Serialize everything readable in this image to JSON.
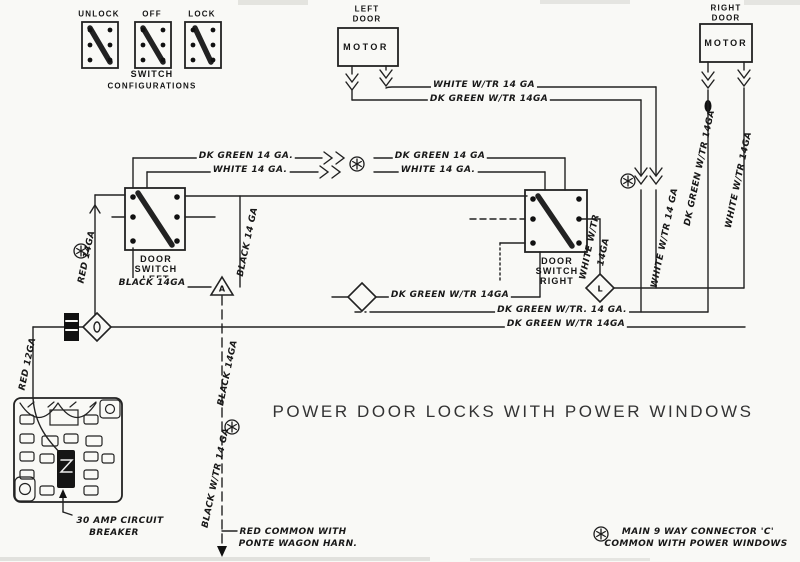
{
  "title": "POWER DOOR LOCKS WITH POWER WINDOWS",
  "switch_config": {
    "labels": [
      "UNLOCK",
      "OFF",
      "LOCK"
    ],
    "caption_line1": "SWITCH",
    "caption_line2": "CONFIGURATIONS"
  },
  "left_motor": {
    "loc1": "LEFT",
    "loc2": "DOOR",
    "label": "MOTOR"
  },
  "right_motor": {
    "loc1": "RIGHT",
    "loc2": "DOOR",
    "label": "MOTOR"
  },
  "left_switch": {
    "l1": "DOOR",
    "l2": "SWITCH",
    "l3": "LEFT"
  },
  "right_switch": {
    "l1": "DOOR",
    "l2": "SWITCH",
    "l3": "RIGHT"
  },
  "wires": {
    "top_white": "WHITE W/TR 14 GA",
    "top_dk_green": "DK GREEN W/TR 14GA",
    "mid_dk_green_left": "DK GREEN 14 GA.",
    "mid_white_left": "WHITE 14 GA.",
    "mid_dk_green_right": "DK GREEN 14 GA",
    "mid_white_right": "WHITE 14 GA.",
    "low_dk_green_1": "DK GREEN W/TR 14GA",
    "low_dk_green_2": "DK GREEN W/TR. 14 GA.",
    "low_dk_green_3": "DK GREEN W/TR 14GA",
    "red_14": "RED 14GA",
    "red_12": "RED 12GA",
    "black_14_vert": "BLACK 14 GA",
    "black_14": "BLACK 14GA",
    "black_mid_top": "BLACK 14GA",
    "black_mid_bottom": "BLACK W/TR 14 GA",
    "white_switch_1": "WHITE W/TR",
    "white_switch_2": "14GA",
    "white_inner": "WHITE W/TR 14 GA",
    "dk_green_right_vert": "DK GREEN W/TR 14GA",
    "white_right_vert": "WHITE W/TR 14GA"
  },
  "connectors": {
    "a": "A",
    "l": "L"
  },
  "notes": {
    "breaker_line1": "30 AMP CIRCUIT",
    "breaker_line2": "BREAKER",
    "harness_line1": "RED COMMON WITH",
    "harness_line2": "PONTE WAGON HARN.",
    "main_line1": "MAIN 9 WAY CONNECTOR 'C'",
    "main_line2": "COMMON WITH POWER WINDOWS"
  }
}
